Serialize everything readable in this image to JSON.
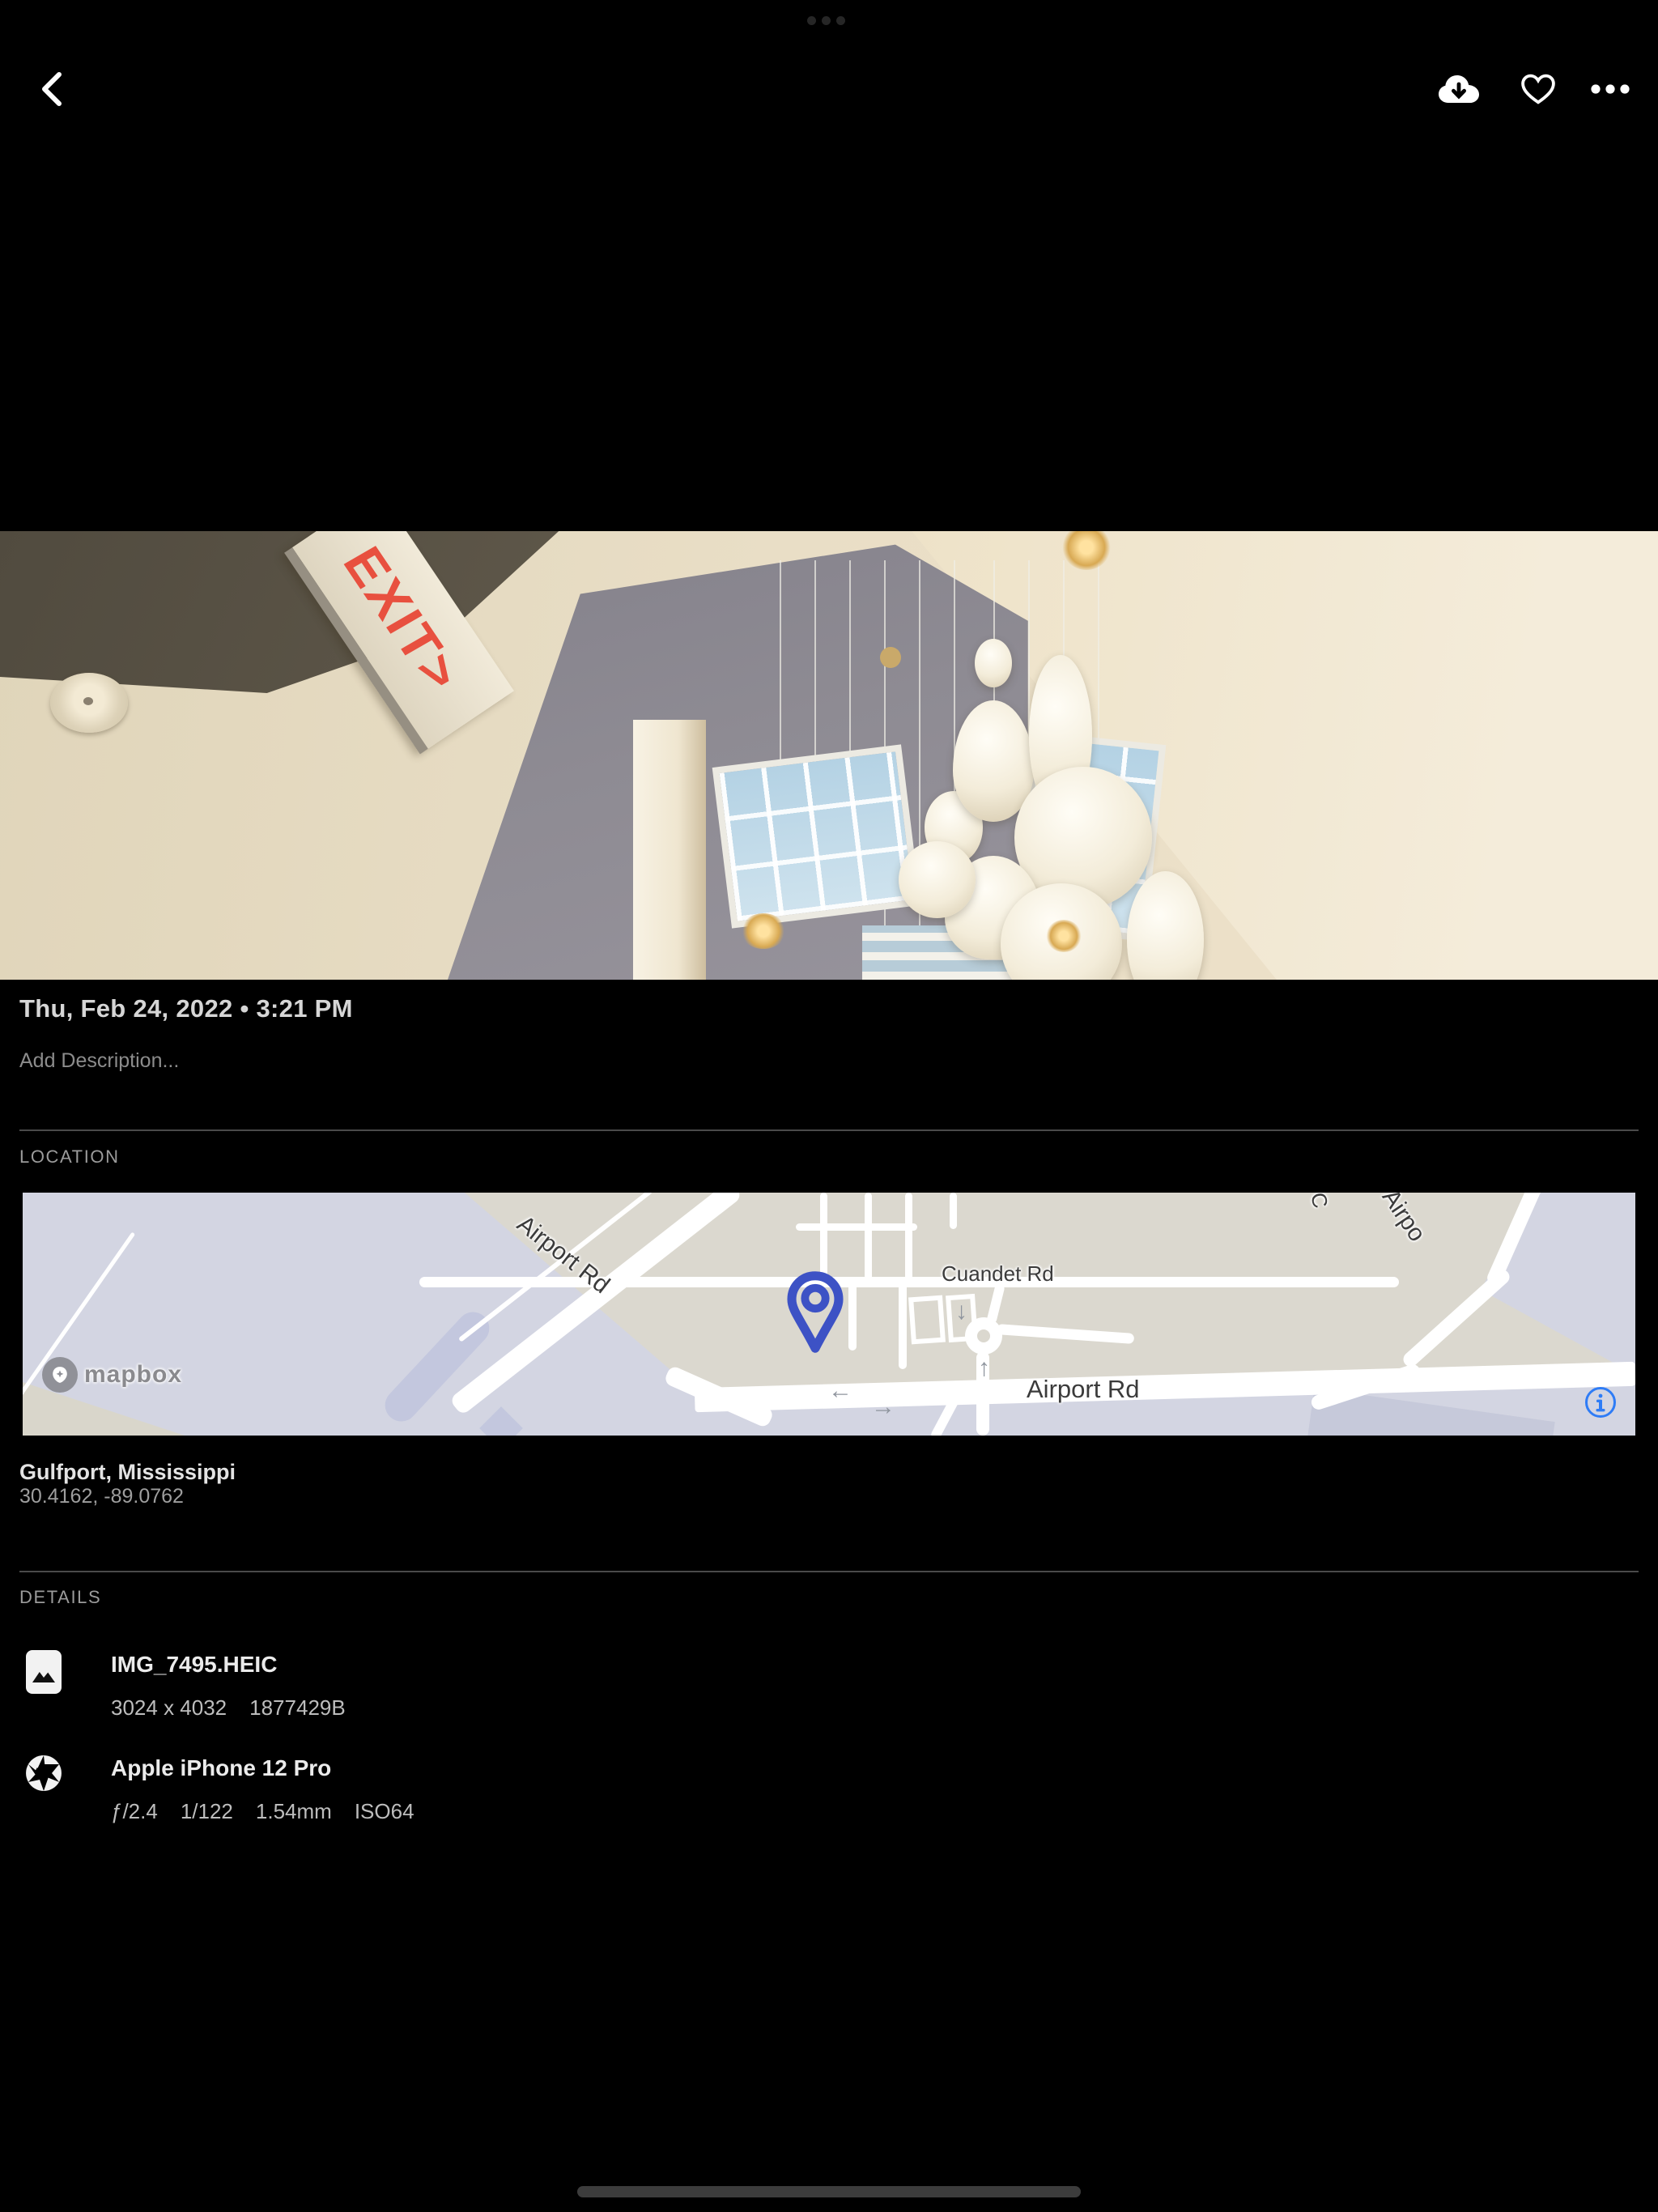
{
  "header": {
    "icons": {
      "back": "chevron-left",
      "download": "cloud-arrow-down",
      "favorite": "heart-outline",
      "more": "ellipsis"
    }
  },
  "photo": {
    "exit_sign_text": "EXIT>",
    "date_line": "Thu, Feb 24, 2022 • 3:21 PM",
    "description_placeholder": "Add Description..."
  },
  "location": {
    "section_label": "LOCATION",
    "place": "Gulfport, Mississippi",
    "coordinates": "30.4162, -89.0762",
    "map": {
      "labels": {
        "airport_rd_diagonal": "Airport Rd",
        "cuandet_rd": "Cuandet Rd",
        "airport_rd_main": "Airport Rd",
        "partial_top_c": "C",
        "partial_top_airport": "Airpo"
      },
      "arrows": {
        "left": "←",
        "right": "→",
        "up": "↑",
        "down": "↓"
      },
      "attribution": "mapbox",
      "info_glyph": "i",
      "colors": {
        "land": "#dbd8cf",
        "airport_area": "#d3d5e2",
        "road": "#ffffff",
        "pin": "#3d52c5",
        "info": "#2e7cf6"
      }
    }
  },
  "details": {
    "section_label": "DETAILS",
    "rows": [
      {
        "icon": "image-file-icon",
        "title": "IMG_7495.HEIC",
        "meta": [
          "3024 x 4032",
          "1877429B"
        ]
      },
      {
        "icon": "aperture-icon",
        "title": "Apple iPhone 12 Pro",
        "meta": [
          "ƒ/2.4",
          "1/122",
          "1.54mm",
          "ISO64"
        ]
      }
    ]
  }
}
